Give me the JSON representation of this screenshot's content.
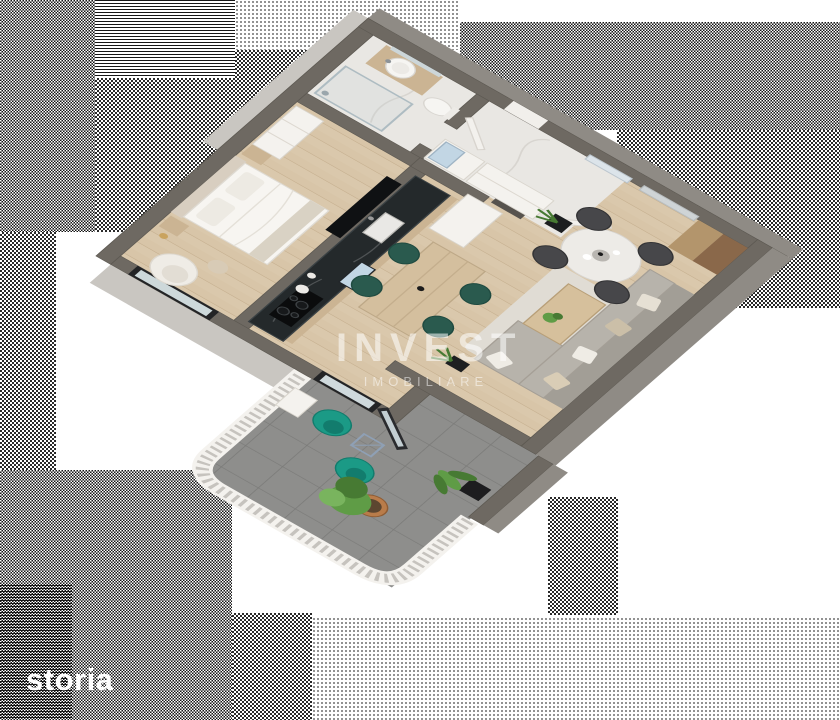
{
  "scene": {
    "alt": "3D isometric floor plan render of a one-bedroom apartment with bathroom, hallway, kitchen, living-dining room and tiled terrace",
    "watermark": {
      "line1": "INVEST",
      "line2": "IMOBILIARE"
    },
    "portal_logo": "storia"
  },
  "colors": {
    "wall-top": "#6e6962",
    "wall-side": "#8f8b85",
    "wall-faint": "#c9c6c1",
    "wood": "#d8c5a8",
    "wood-line": "#c3ad8c",
    "marble": "#e9e7e3",
    "tile": "#8e8e8c",
    "grout": "#7b7b79",
    "rug": "#e0dcd4",
    "sofa": "#b7b3ab",
    "sofa-dark": "#a29e96",
    "teal": "#1b9a86",
    "teal-dark": "#127c6d",
    "counter": "#24292b",
    "cabinet": "#cbb493",
    "white": "#f4f2ee",
    "dark": "#17191c",
    "chair-dark": "#47474a",
    "chair-green": "#2a5a4e",
    "green": "#5f9c46",
    "green-dark": "#477a33",
    "terracotta": "#b97c4a",
    "oak": "#b3956c",
    "walnut": "#8a684a",
    "blue-glass": "#c2d6e4",
    "shelf": "#57534e"
  }
}
